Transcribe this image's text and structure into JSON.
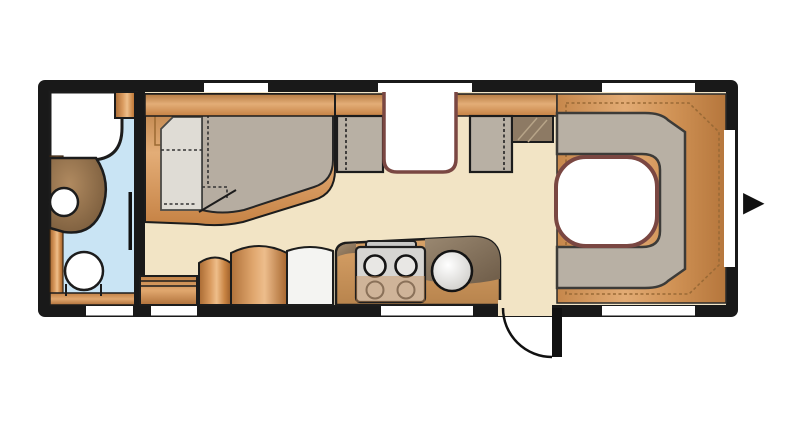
{
  "app": {
    "type": "caravan-floorplan-diagram"
  },
  "palette": {
    "wall_black": "#191919",
    "floor_cream": "#f2e4c5",
    "bathroom_blue": "#c9e4f4",
    "cushion_gray": "#b8b0a4",
    "mattress_gray": "#b6ada1",
    "mattress_light": "#dfdcd5",
    "table_border": "#7a4742",
    "table_fill": "#ffffff",
    "wood_mid": "#cf9154",
    "counter_dark": "#8c7a64",
    "stove_gray": "#d6d5d2",
    "window_white": "#ffffff",
    "arrow_black": "#111111"
  },
  "floorplan": {
    "entry_arrow_glyph": "▶",
    "elements": [
      {
        "name": "shower-tray"
      },
      {
        "name": "washbasin"
      },
      {
        "name": "vanity-counter"
      },
      {
        "name": "toilet"
      },
      {
        "name": "bathroom-sliding-door"
      },
      {
        "name": "double-bed"
      },
      {
        "name": "wardrobe-top-shelf"
      },
      {
        "name": "dinette-bench-left"
      },
      {
        "name": "dinette-bench-right"
      },
      {
        "name": "dinette-table"
      },
      {
        "name": "mid-cabinet"
      },
      {
        "name": "lower-sideboard"
      },
      {
        "name": "wardrobe-arched-small"
      },
      {
        "name": "wardrobe-arched-large"
      },
      {
        "name": "refrigerator"
      },
      {
        "name": "kitchen-counter"
      },
      {
        "name": "stove-4-burner"
      },
      {
        "name": "kitchen-sink"
      },
      {
        "name": "entry-door-swing"
      },
      {
        "name": "rear-u-lounge"
      },
      {
        "name": "lounge-table"
      },
      {
        "name": "entry-arrow"
      }
    ]
  }
}
